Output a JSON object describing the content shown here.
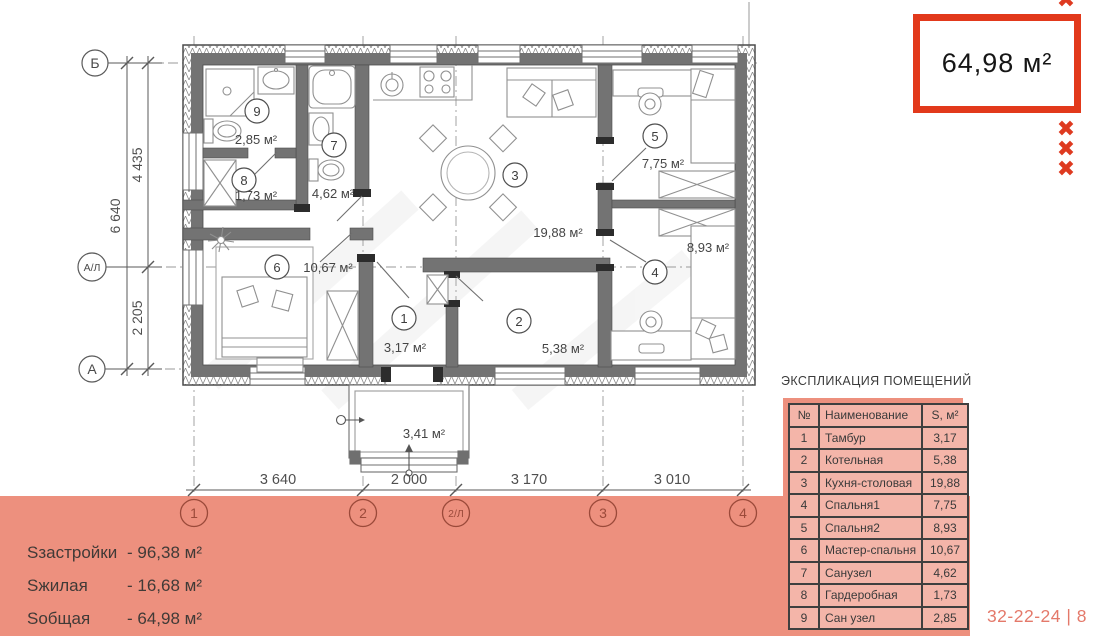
{
  "colors": {
    "accent_red": "#e2391b",
    "salmon_band": "#ed907e",
    "table_cell": "#f4b5a9",
    "sheet_code_text": "#e4796a"
  },
  "area_box": {
    "value": "64,98 м²"
  },
  "decor": {
    "x_mark": "✖"
  },
  "plan": {
    "rooms": [
      {
        "number": "1",
        "area": "3,17 м²"
      },
      {
        "number": "2",
        "area": "5,38 м²"
      },
      {
        "number": "3",
        "area": "19,88 м²"
      },
      {
        "number": "4",
        "area": "8,93 м²"
      },
      {
        "number": "5",
        "area": "7,75 м²"
      },
      {
        "number": "6",
        "area": "10,67 м²"
      },
      {
        "number": "7",
        "area": "4,62 м²"
      },
      {
        "number": "8",
        "area": "1,73 м²"
      },
      {
        "number": "9",
        "area": "2,85 м²"
      }
    ],
    "porch_area": "3,41 м²",
    "dims_bottom": [
      "3 640",
      "2 000",
      "3 170",
      "3 010"
    ],
    "axes_bottom": [
      "1",
      "2",
      "2/Л",
      "3",
      "4"
    ],
    "dims_left": {
      "overall": "6 640",
      "upper": "4 435",
      "lower": "2 205"
    },
    "axes_left": [
      "Б",
      "А/Л",
      "А"
    ]
  },
  "legend_table": {
    "title": "ЭКСПЛИКАЦИЯ ПОМЕЩЕНИЙ",
    "headers": {
      "num": "№",
      "name": "Наименование",
      "area": "S, м²"
    },
    "rows": [
      {
        "num": "1",
        "name": "Тамбур",
        "area": "3,17"
      },
      {
        "num": "2",
        "name": "Котельная",
        "area": "5,38"
      },
      {
        "num": "3",
        "name": "Кухня-столовая",
        "area": "19,88"
      },
      {
        "num": "4",
        "name": "Спальня1",
        "area": "7,75"
      },
      {
        "num": "5",
        "name": "Спальня2",
        "area": "8,93"
      },
      {
        "num": "6",
        "name": "Мастер-спальня",
        "area": "10,67"
      },
      {
        "num": "7",
        "name": "Санузел",
        "area": "4,62"
      },
      {
        "num": "8",
        "name": "Гардеробная",
        "area": "1,73"
      },
      {
        "num": "9",
        "name": "Сан узел",
        "area": "2,85"
      }
    ]
  },
  "summary": [
    {
      "label": "Sзастройки",
      "value": "- 96,38 м²"
    },
    {
      "label": "Sжилая",
      "value": "- 16,68 м²"
    },
    {
      "label": "Sобщая",
      "value": "- 64,98 м²"
    }
  ],
  "sheet_code": "32-22-24 | 8"
}
